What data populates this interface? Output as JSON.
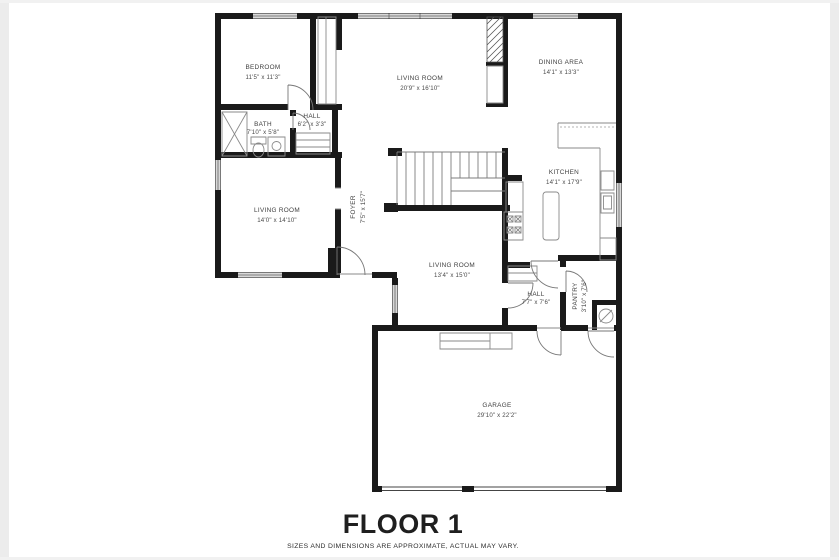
{
  "floor_plan": {
    "title": "FLOOR 1",
    "disclaimer": "SIZES AND DIMENSIONS ARE APPROXIMATE, ACTUAL MAY VARY.",
    "rooms": [
      {
        "id": "bedroom",
        "name": "BEDROOM",
        "dims": "11'5\" x 11'3\""
      },
      {
        "id": "living-room-top",
        "name": "LIVING ROOM",
        "dims": "20'9\" x 16'10\""
      },
      {
        "id": "dining-area",
        "name": "DINING AREA",
        "dims": "14'1\" x 13'3\""
      },
      {
        "id": "bath",
        "name": "BATH",
        "dims": "7'10\" x 5'8\""
      },
      {
        "id": "hall-upper",
        "name": "HALL",
        "dims": "6'2\" x 3'3\""
      },
      {
        "id": "living-room-left",
        "name": "LIVING ROOM",
        "dims": "14'0\" x 14'10\""
      },
      {
        "id": "foyer",
        "name": "FOYER",
        "dims": "7'5\" x 15'7\""
      },
      {
        "id": "living-room-center",
        "name": "LIVING ROOM",
        "dims": "13'4\" x 15'0\""
      },
      {
        "id": "kitchen",
        "name": "KITCHEN",
        "dims": "14'1\" x 17'9\""
      },
      {
        "id": "hall-lower",
        "name": "HALL",
        "dims": "7'7\" x 7'6\""
      },
      {
        "id": "pantry",
        "name": "PANTRY",
        "dims": "3'10\" x 7'6\""
      },
      {
        "id": "garage",
        "name": "GARAGE",
        "dims": "29'10\" x 22'2\""
      }
    ],
    "colors": {
      "wall": "#1a1a1a",
      "window": "#d8d8d8",
      "fixture": "#8a8a8a",
      "label": "#3f3f3f",
      "frame": "#ececec"
    }
  }
}
